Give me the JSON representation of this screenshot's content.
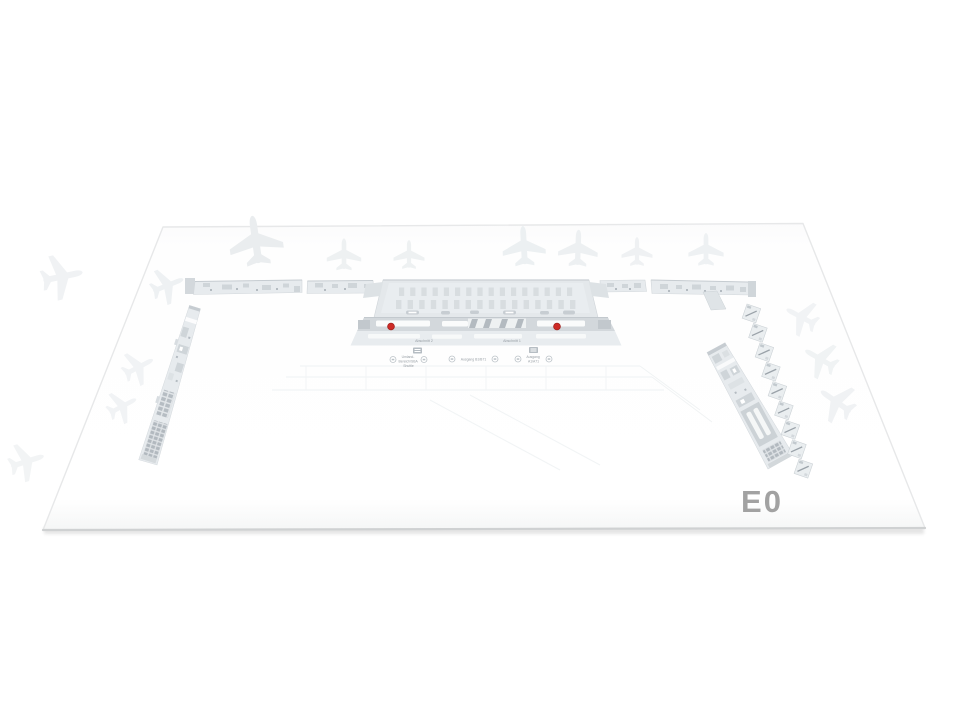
{
  "theme": {
    "accent_red": "#ce2b26",
    "accent_red_rim": "#a32420",
    "label_gray": "#a2a2a2",
    "text_gray": "#979ea4",
    "pier_light": "#e7ebee",
    "pier_mid": "#cfd5d9",
    "pier_dark": "#b4bbc1",
    "band_gray": "#d3d8dc",
    "block_gray": "#e4e8eb",
    "edge_gray": "#e7e8e9"
  },
  "map": {
    "level_label": "E0",
    "markers": [
      {
        "name": "poi-marker-left",
        "x": 391,
        "y": 326.5,
        "r": 3.4
      },
      {
        "name": "poi-marker-right",
        "x": 557,
        "y": 326.5,
        "r": 3.4
      }
    ],
    "terminal_labels": [
      {
        "text": "Abschnitt 2"
      },
      {
        "text": "Abschnitt 1"
      }
    ],
    "stops": [
      {
        "lines": [
          "Umland-",
          "Bereich/SBA",
          "Shuttle"
        ]
      },
      {
        "lines": [
          "Ausgang B1/B71"
        ]
      },
      {
        "lines": [
          "Ausgang",
          "A1/A71"
        ]
      }
    ]
  }
}
